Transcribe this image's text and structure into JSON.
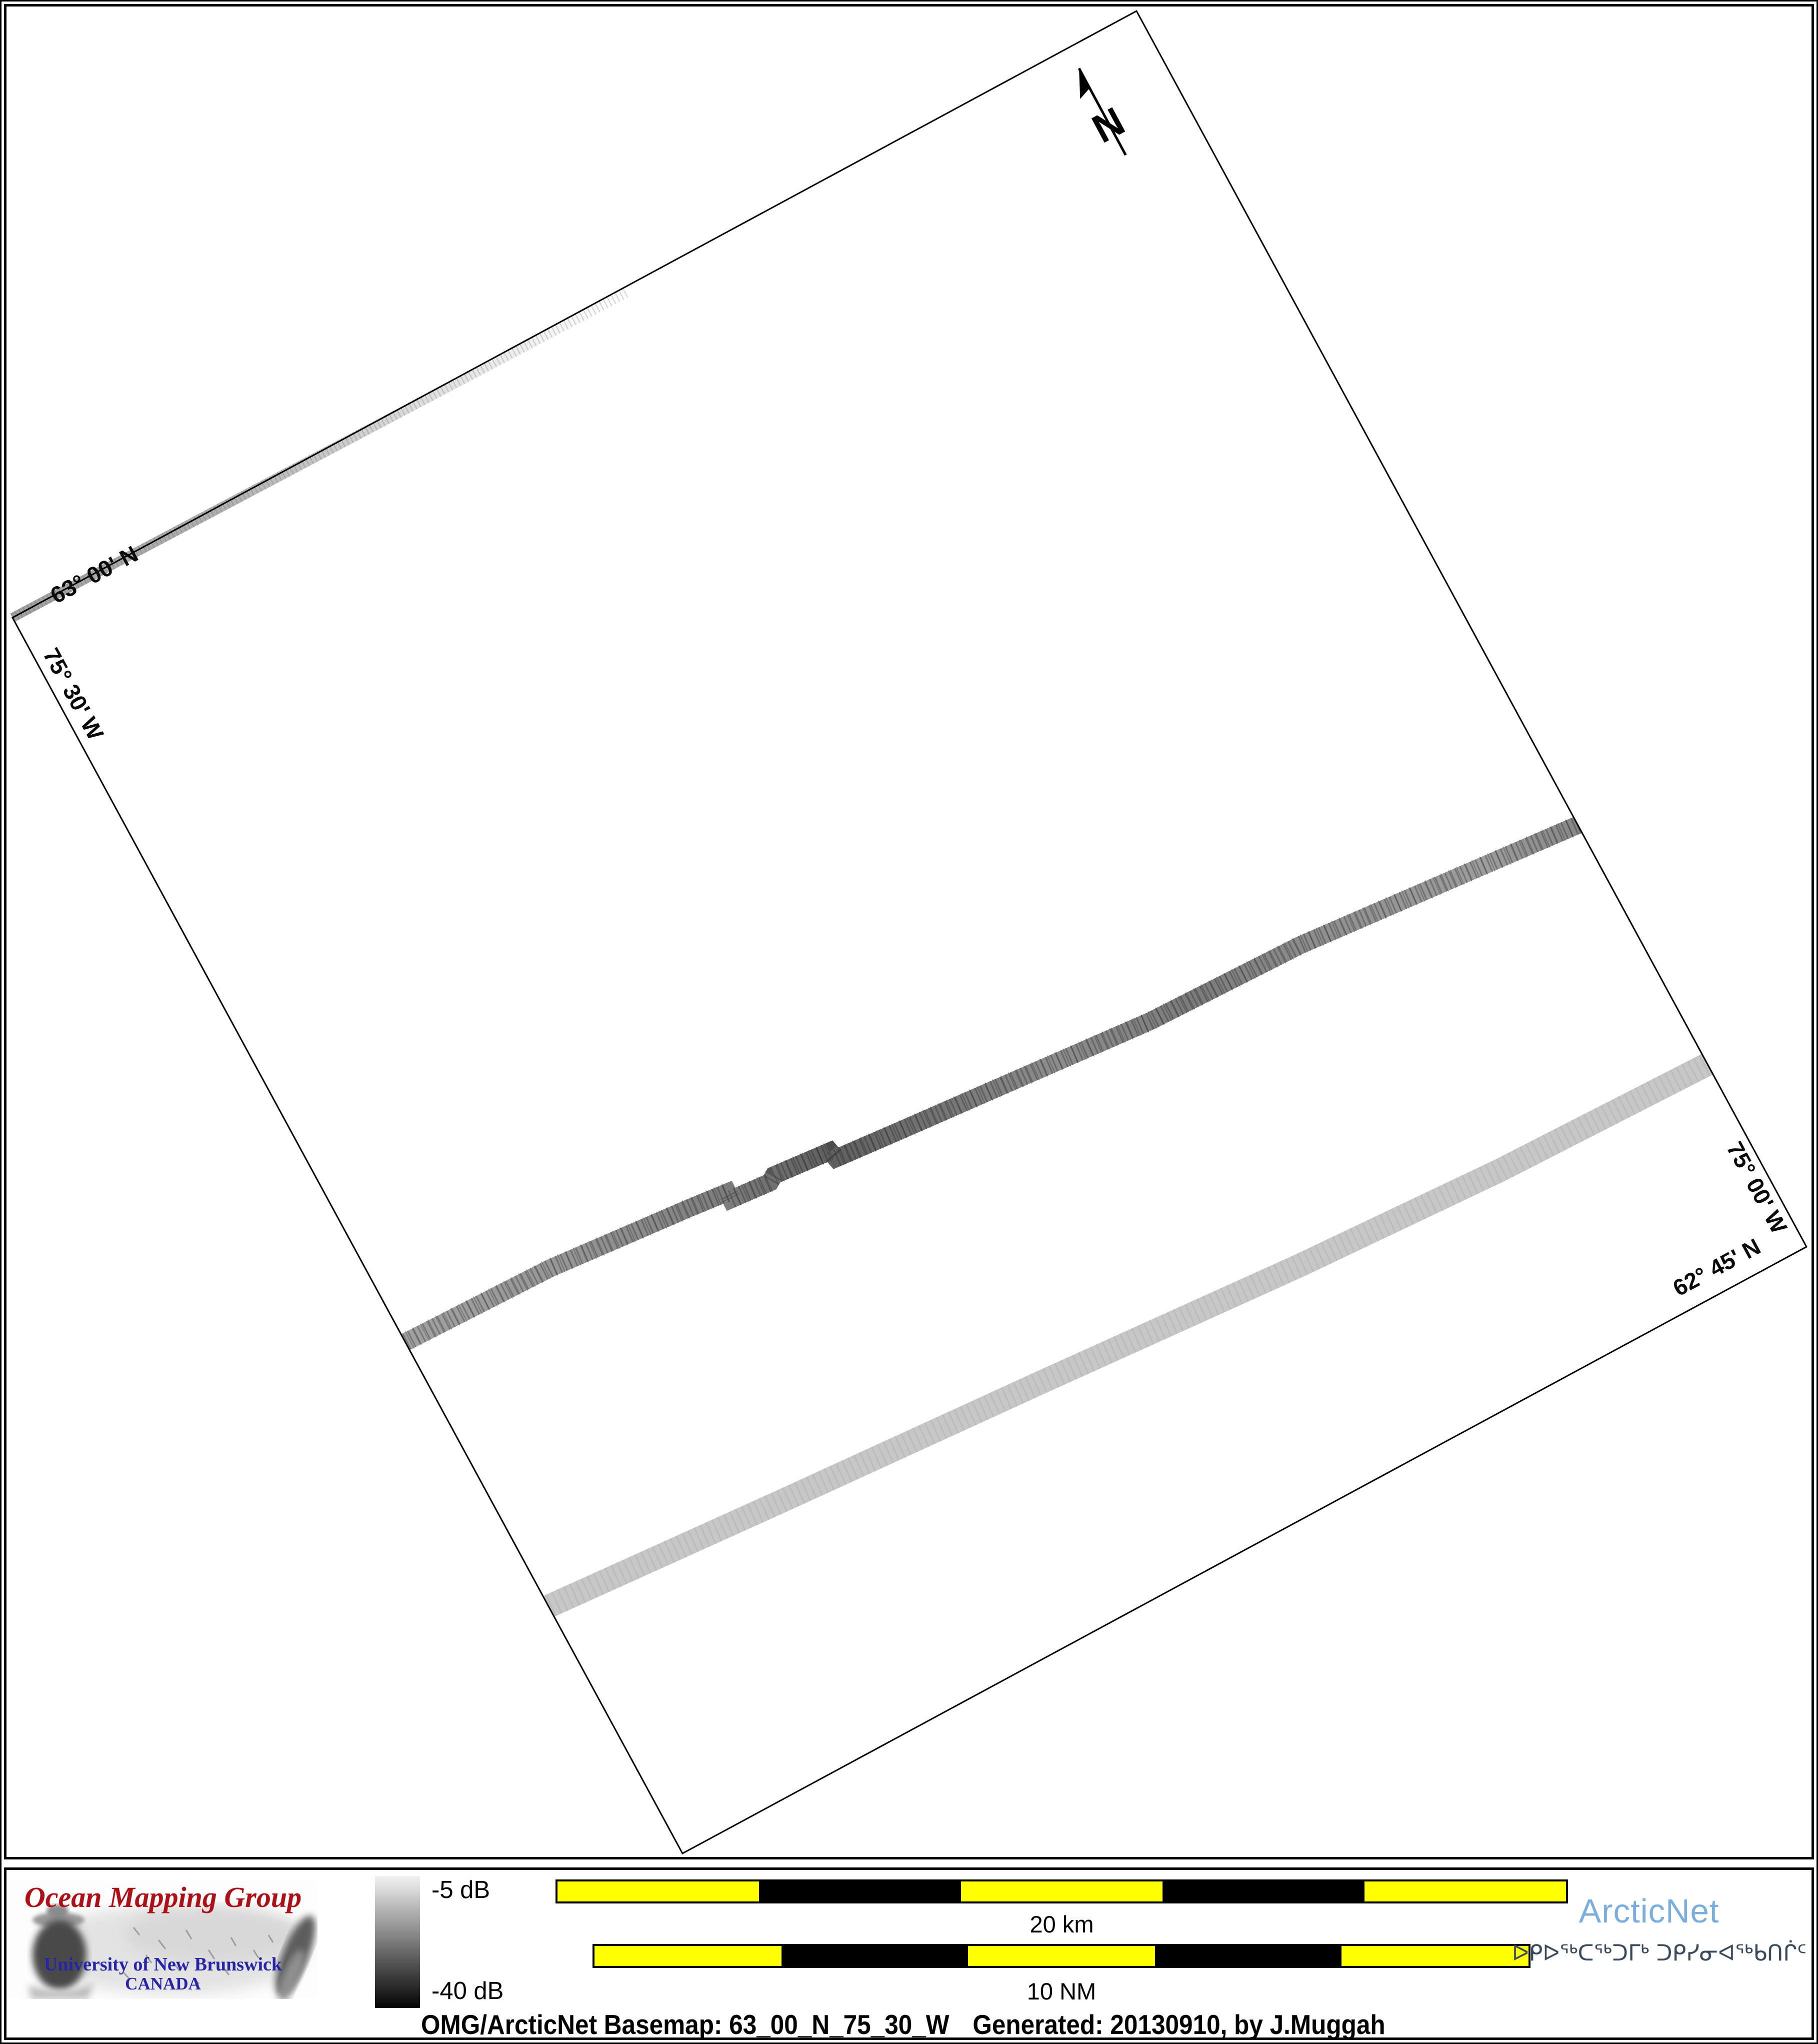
{
  "map": {
    "graticule_labels": {
      "top_latitude": "63° 00' N",
      "left_longitude": "75° 30' W",
      "right_longitude": "75° 00' W",
      "bottom_latitude": "62° 45' N"
    },
    "north_arrow_label": "N"
  },
  "legend": {
    "colorbar": {
      "top_label": "-5 dB",
      "bottom_label": "-40 dB",
      "top_color": "#f2f2f2",
      "bottom_color": "#030303"
    },
    "scalebars": [
      {
        "label": "20 km",
        "segments": [
          "#ffff00",
          "#000000",
          "#ffff00",
          "#000000",
          "#ffff00"
        ]
      },
      {
        "label": "10 NM",
        "segments": [
          "#ffff00",
          "#000000",
          "#ffff00",
          "#000000",
          "#ffff00"
        ]
      }
    ]
  },
  "omg_logo": {
    "title": "Ocean Mapping Group",
    "title_color": "#ad1017",
    "subtitle": "University of New Brunswick",
    "country": "CANADA",
    "subtitle_color": "#2824a6"
  },
  "arcticnet_logo": {
    "name": "ArcticNet",
    "name_color": "#7caedd",
    "syllabics": "ᐅᑭᐅᖅᑕᖅᑐᒥᒃ ᑐᑭᓯᓂᐊᖅᑲᑎᒌᑦ",
    "syllabics_color": "#3a4a5e"
  },
  "caption": {
    "basemap": "OMG/ArcticNet Basemap: 63_00_N_75_30_W",
    "generated": "Generated: 20130910, by J.Muggah"
  }
}
